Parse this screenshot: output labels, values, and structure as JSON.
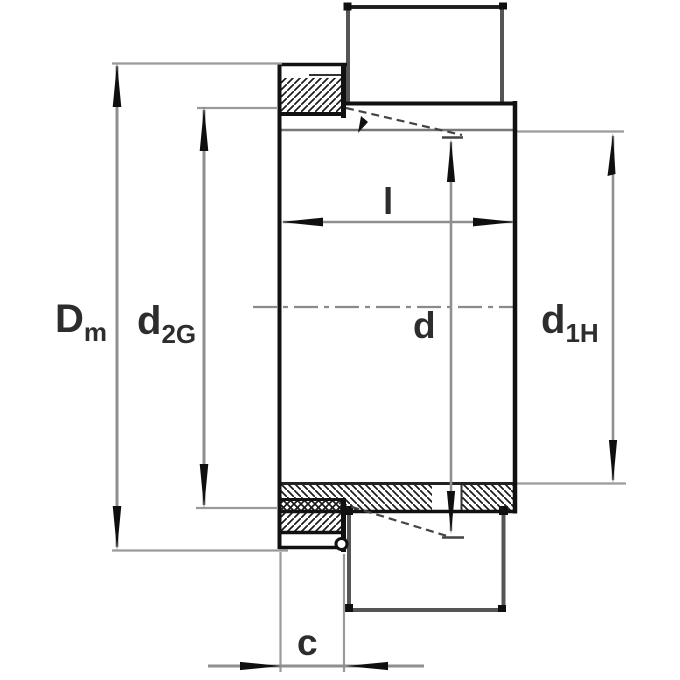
{
  "figure": {
    "type": "technical-dimension-drawing",
    "subject": "Adapter sleeve with locknut, half-section with bearing seat",
    "units_shown": "none (symbolic dimension letters only)"
  },
  "labels": {
    "Dm": {
      "main": "D",
      "sub": "m"
    },
    "d2G": {
      "main": "d",
      "sub": "2G"
    },
    "l": {
      "main": "l"
    },
    "d": {
      "main": "d"
    },
    "d1H": {
      "main": "d",
      "sub": "1H"
    },
    "c": {
      "main": "c"
    }
  },
  "dimensions": [
    {
      "name": "Dm",
      "meaning": "locknut outside diameter",
      "orientation": "vertical"
    },
    {
      "name": "d2G",
      "meaning": "thread diameter",
      "orientation": "vertical"
    },
    {
      "name": "d",
      "meaning": "bore / shaft diameter",
      "orientation": "vertical"
    },
    {
      "name": "d1H",
      "meaning": "sleeve bore diameter",
      "orientation": "vertical"
    },
    {
      "name": "l",
      "meaning": "sleeve width",
      "orientation": "horizontal"
    },
    {
      "name": "c",
      "meaning": "nut width",
      "orientation": "horizontal"
    }
  ],
  "colors": {
    "background": "#ffffff",
    "object_line": "#111111",
    "medium_line": "#555555",
    "dimension_line": "#8f8f8f",
    "extension_line": "#9a9a9a",
    "arrowhead": "#0f0f0f",
    "text": "#2d2d2d"
  }
}
